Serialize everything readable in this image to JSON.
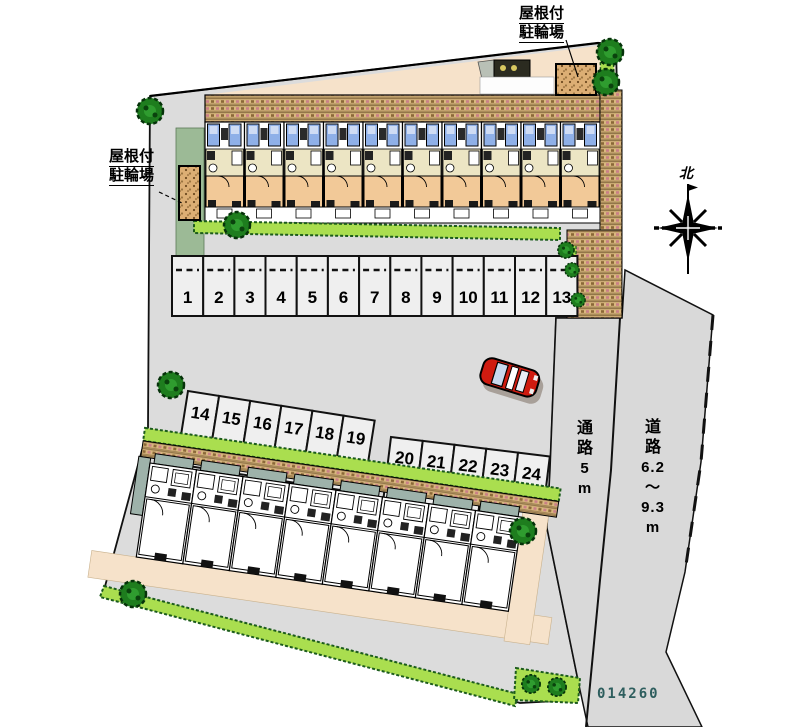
{
  "plan": {
    "number": "014260",
    "north_label": "北"
  },
  "labels": {
    "bike_shed_top": {
      "line1": "屋根付",
      "line2": "駐輪場"
    },
    "bike_shed_left": {
      "line1": "屋根付",
      "line2": "駐輪場"
    },
    "passage": {
      "full": "通路5m",
      "chars": [
        "通",
        "路",
        "5",
        "m"
      ]
    },
    "road": {
      "full": "道路6.2～9.3m",
      "chars": [
        "道",
        "路",
        "6.2",
        "～",
        "9.3",
        "m"
      ]
    }
  },
  "parking": {
    "row_north": [
      "1",
      "2",
      "3",
      "4",
      "5",
      "6",
      "7",
      "8",
      "9",
      "10",
      "11",
      "12",
      "13"
    ],
    "row_mid_west": [
      "14",
      "15",
      "16",
      "17",
      "18",
      "19"
    ],
    "row_mid_east": [
      "20",
      "21",
      "22",
      "23",
      "24"
    ]
  },
  "colors": {
    "site_gray": "#dcdcdc",
    "road_gray": "#d9d9d9",
    "stall_fill": "#efefef",
    "brick_tan": "#d9b77f",
    "hedge_green": "#aade4f",
    "tree_green": "#1e7d1e",
    "room_peach": "#f2c998",
    "kitchen_cream": "#ece5c4",
    "window_blue": "#8fb0e8",
    "balcony_teal": "#9eb2aa",
    "walkway_cream": "#f6e2ca",
    "car_red": "#cf1b10",
    "plan_number_teal": "#2e5e5e"
  }
}
